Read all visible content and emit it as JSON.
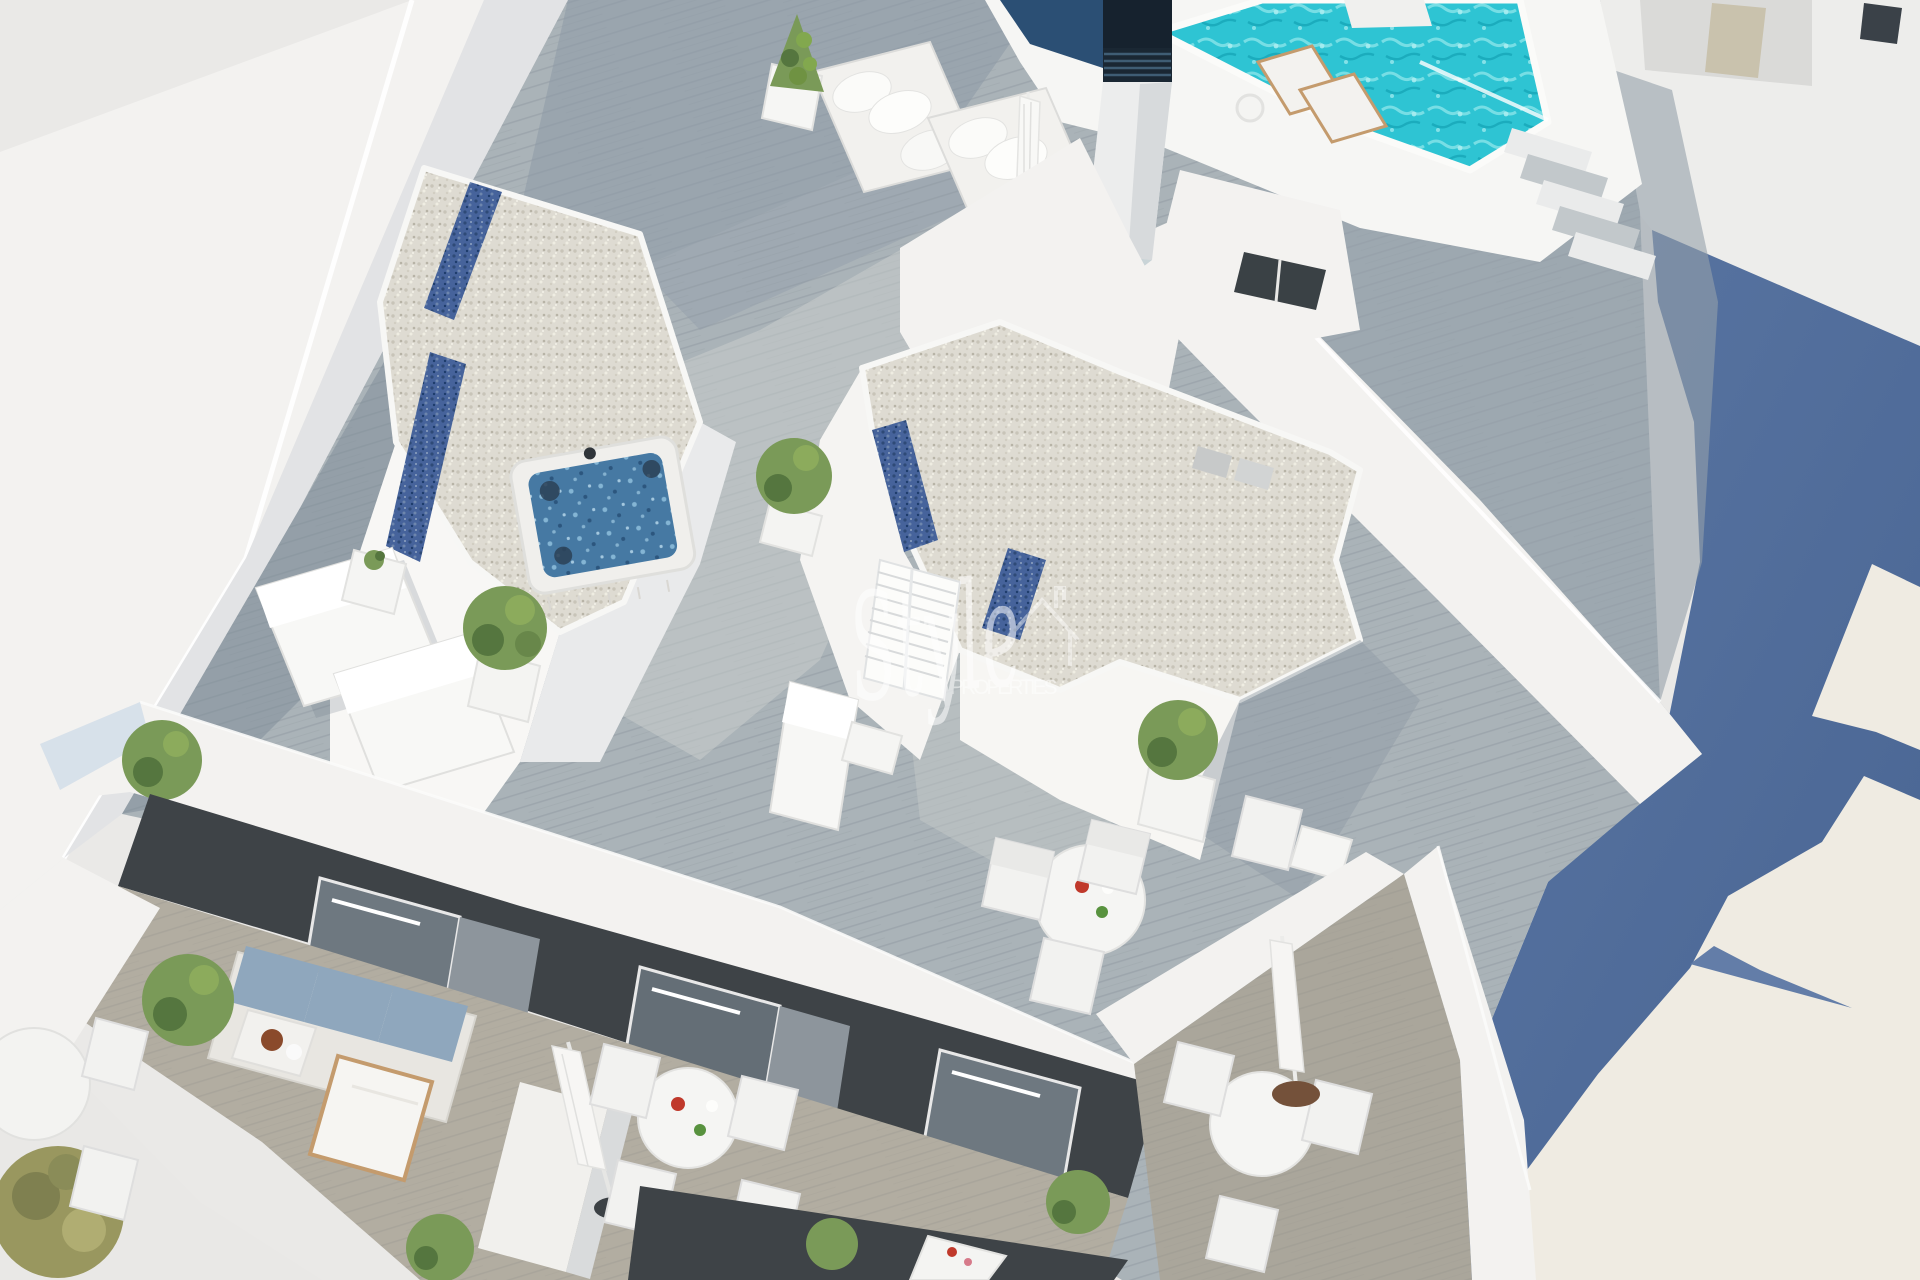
{
  "scene": {
    "type": "architectural-3d-render",
    "description": "Aerial 3D rendering of a new-build apartment building rooftop solarium with swimming pool, jacuzzi, sun loungers, gravel roofs and furnished balconies, neighbouring wall in blue shadow"
  },
  "watermark": {
    "brand_script": "Style",
    "brand_caps": "PROPERTIES",
    "logo_icon": "house-outline-icon"
  },
  "colors": {
    "background": "#eae9e7",
    "wall_white": "#f3f2f0",
    "wall_shade": "#e2e3e5",
    "lit_wall_warm": "#efebe2",
    "shadow_blue": "#5b77a4",
    "shadow_blue_dark": "#486492",
    "deck_wood": "#aab3b8",
    "deck_shade": "#8d99a5",
    "deck_sun": "#ccd0cd",
    "pool_turquoise": "#2ec4d3",
    "pool_ripple": "#7fe2e7",
    "gravel": "#dedbd2",
    "gravel_blue": "#46639b",
    "jacuzzi_water": "#4679a3",
    "facade_dark": "#3e4347",
    "curtain_gray": "#8d959c",
    "plant_green": "#7a9a58",
    "plant_dark": "#55763f",
    "olive_green": "#99975f",
    "cushion_blue": "#8fa7bd",
    "wood_furniture": "#c49b6d",
    "umbrella_base": "#3c4145",
    "watermark_white": "#ffffff"
  }
}
